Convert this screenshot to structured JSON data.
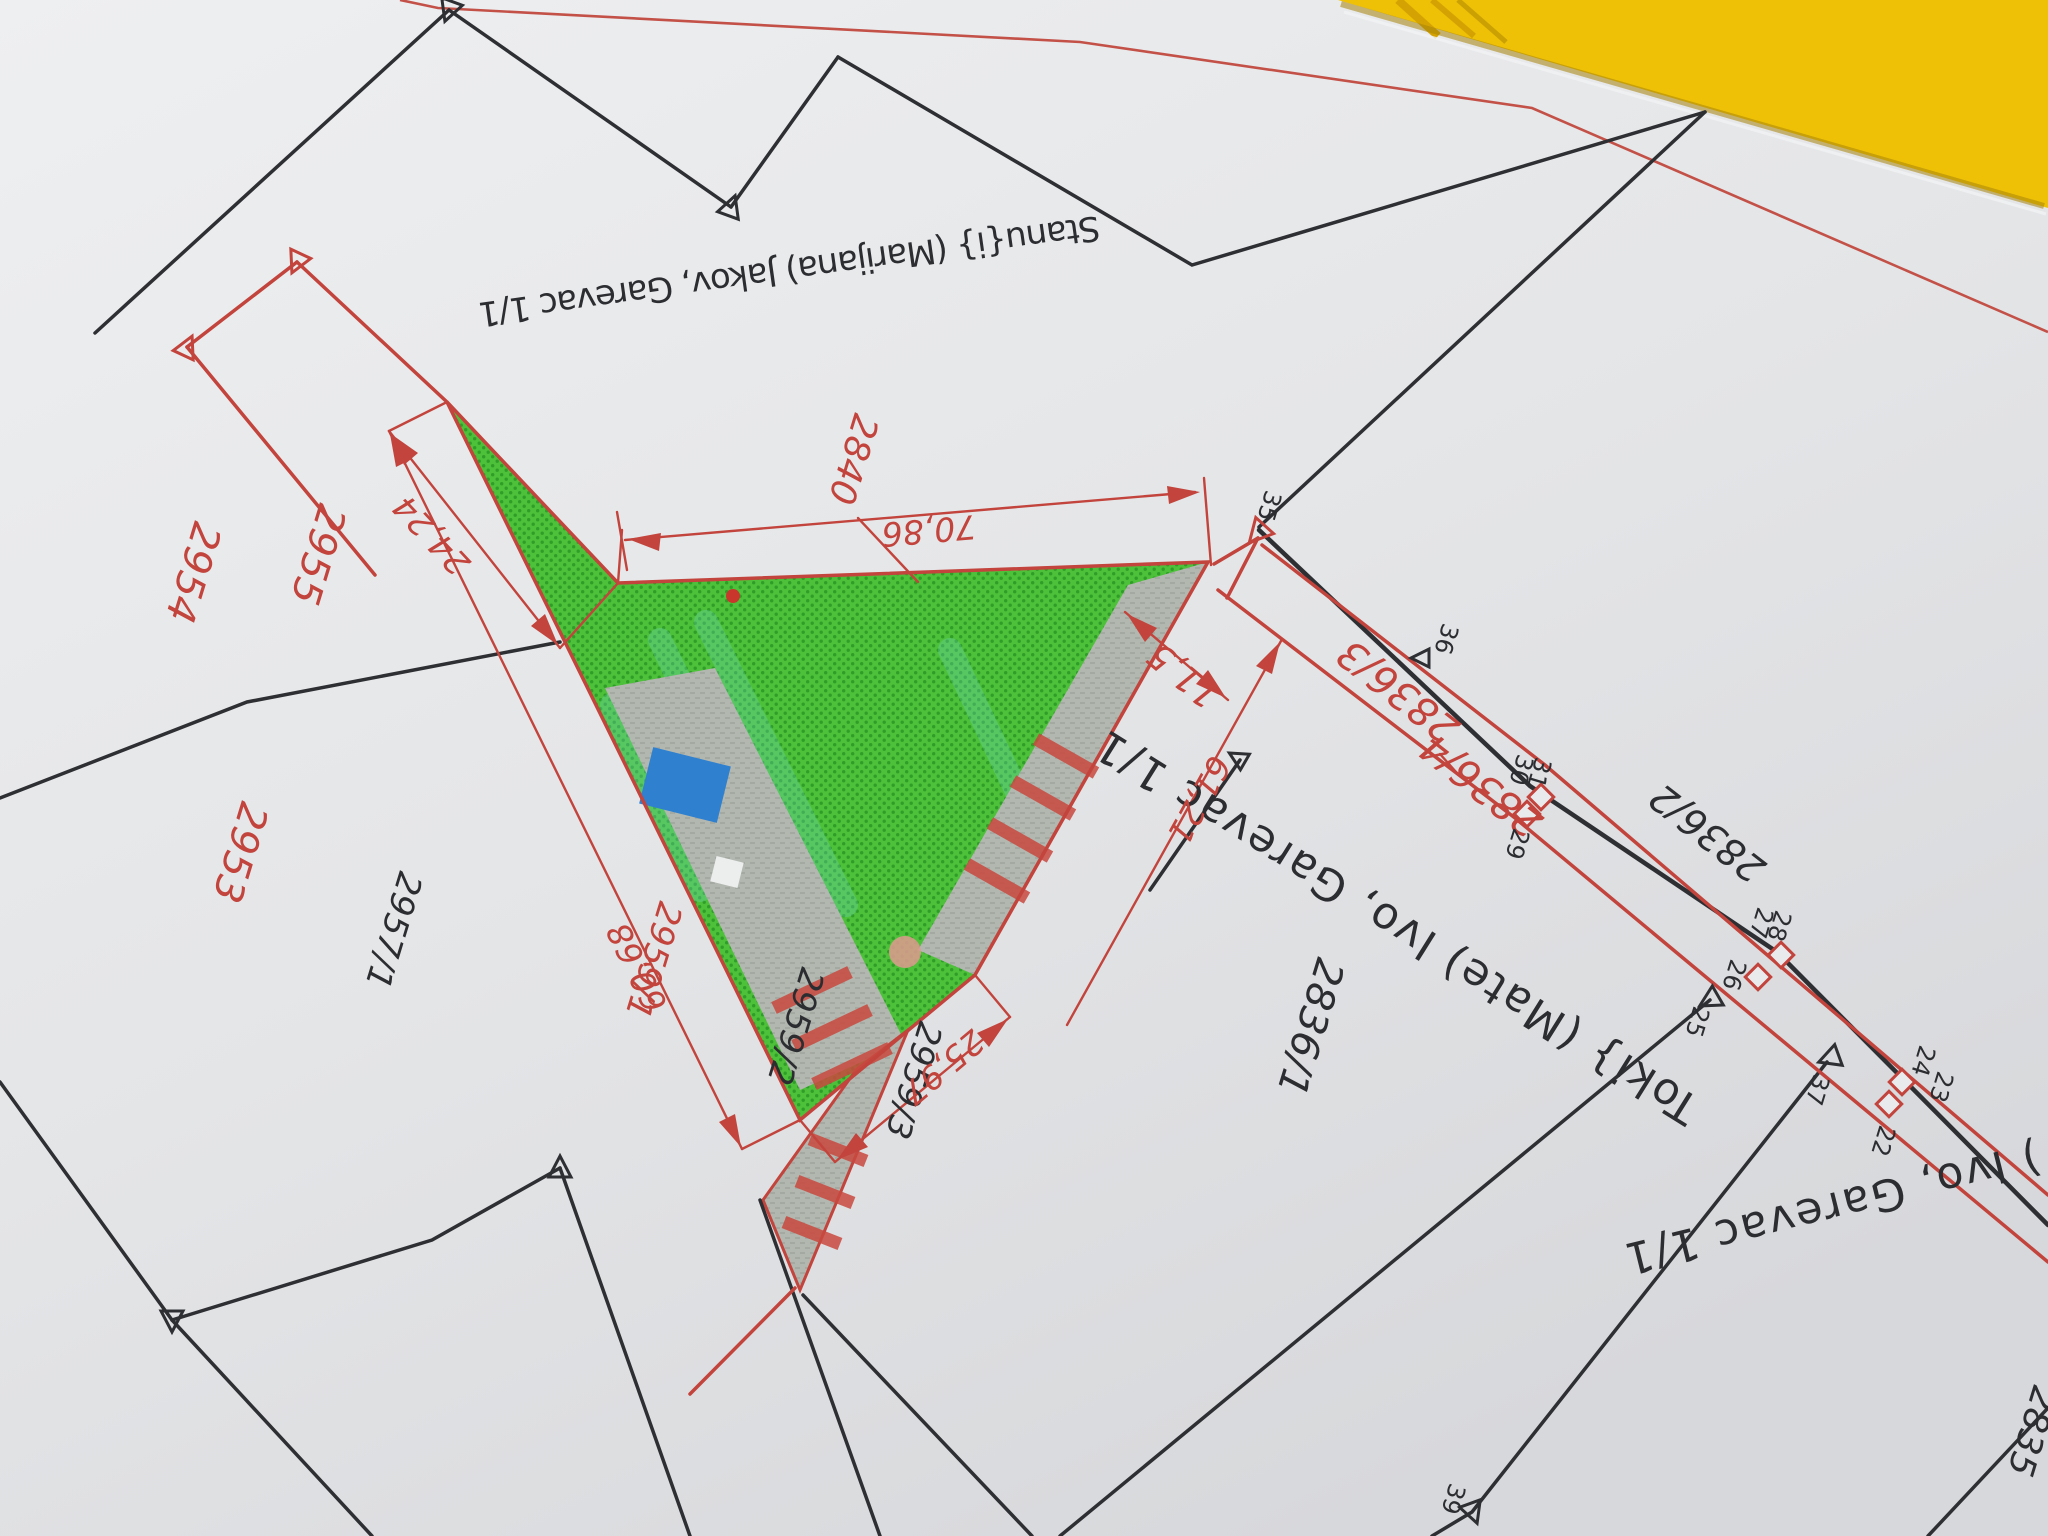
{
  "colors": {
    "paper": "#e4e5e7",
    "folder_yellow": "#eec106",
    "boundary_red": "#c2443c",
    "boundary_black": "#2e2f33",
    "parcel_green": "#4ec13a",
    "surface_gray": "#b2b7b0",
    "pool_blue": "#2f80cf"
  },
  "owners": {
    "owner_1": "Stanu{i} (Marijana) Jakov, Garevac 1/1",
    "owner_2": "Toki} (Mate) Ivo, Garevac 1/1",
    "owner_3": ") Ivo, Garevac 1/1"
  },
  "parcels": {
    "p2840": "2840",
    "p2955": "2955",
    "p2954": "2954",
    "p2953": "2953",
    "p2957_1": "2957/1",
    "p2959_1": "2959/1",
    "p2959_2": "2959/2",
    "p2959_3": "2959/3",
    "p2836_1": "2836/1",
    "p2836_2": "2836/2",
    "p2836_3": "2836/3",
    "p2836_4": "2836/4",
    "p2835": "2835"
  },
  "dimensions": {
    "d70_86": "70,86",
    "d24_24": "24,24",
    "d60_68": "60,68",
    "d25_97": "25,97",
    "d11_5": "11,5",
    "d61_21": "61,21"
  },
  "points": {
    "pt22": "22",
    "pt23": "23",
    "pt24": "24",
    "pt25": "25",
    "pt26": "26",
    "pt27": "27",
    "pt28": "28",
    "pt29": "29",
    "pt30": "30",
    "pt31": "31",
    "pt35": "35",
    "pt36": "36",
    "pt37": "37",
    "pt39": "39"
  }
}
